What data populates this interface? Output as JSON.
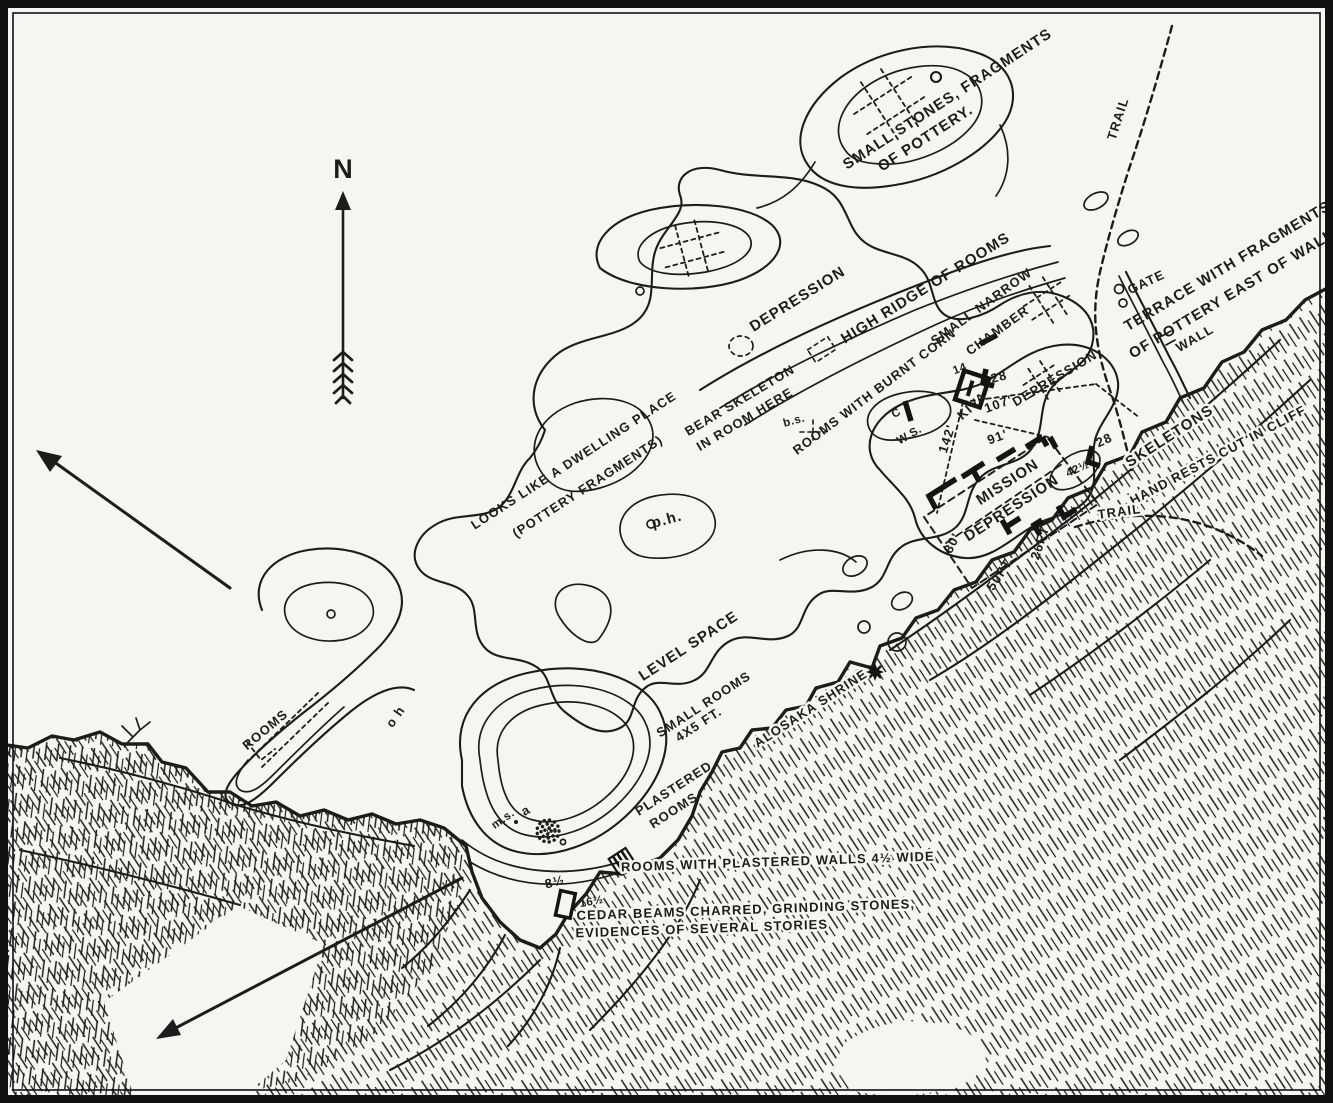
{
  "palette": {
    "paper": "#f7f5f0",
    "ink": "#1c1c1c"
  },
  "compass": {
    "label": "N"
  },
  "icons": {
    "north_arrow": "feathered-north-arrow",
    "shrine_star": "✱",
    "kiva_symbol": "square-kiva-mark"
  },
  "labels": {
    "pottery_mound1": "SMALL STONES, FRAGMENTS",
    "pottery_mound2": "OF POTTERY.",
    "trail_top": "TRAIL",
    "trail_cliff": "TRAIL",
    "depression_nw": "DEPRESSION",
    "high_ridge": "HIGH RIDGE OF ROOMS",
    "small_narrow1": "SMALL NARROW",
    "small_narrow2": "CHAMBER",
    "gate": "GATE",
    "terrace1": "TERRACE WITH FRAGMENTS",
    "terrace2": "OF POTTERY EAST OF WALL",
    "wall": "WALL",
    "bear1": "BEAR SKELETON",
    "bear2": "IN ROOM HERE",
    "bs_mark": "b.s.",
    "burnt_rooms": "ROOMS WITH BURNT CORN",
    "c_mark": "C",
    "ws_mark": "W.S.",
    "kiva": "KIVA",
    "depression_mid": "DEPRESSION",
    "mission": "MISSION",
    "depression_mission": "DEPRESSION",
    "skeletons": "SKELETONS",
    "hand_rests": "HAND RESTS CUT IN CLIFF",
    "dwelling1": "LOOKS LIKE A DWELLING PLACE",
    "dwelling2": "(POTTERY FRAGMENTS)",
    "ph_mark": "p.h.",
    "oh_mark": "o h",
    "level_space": "LEVEL SPACE",
    "small_rooms1": "SMALL ROOMS",
    "small_rooms2": "4X5 FT.",
    "alosaka": "ALOSAKA SHRINE",
    "rooms_west": "ROOMS",
    "plastered1": "PLASTERED",
    "plastered2": "ROOMS",
    "ms_mark": "m.s.",
    "a_mark": "a",
    "plaster_walls": "ROOMS WITH PLASTERED WALLS 4½ WIDE",
    "cedar": "CEDAR BEAMS CHARRED, GRINDING STONES,",
    "evidences": "EVIDENCES OF SEVERAL STORIES"
  },
  "measurements": {
    "n14": "14",
    "n28a": "28",
    "n107": "107'",
    "n142": "142'",
    "n91": "91'",
    "n80": "80'",
    "n50ft": "50FT",
    "n26ft": "26FT",
    "n42": "42½",
    "n28b": "28",
    "n8h": "8½",
    "n16h": "16½"
  }
}
